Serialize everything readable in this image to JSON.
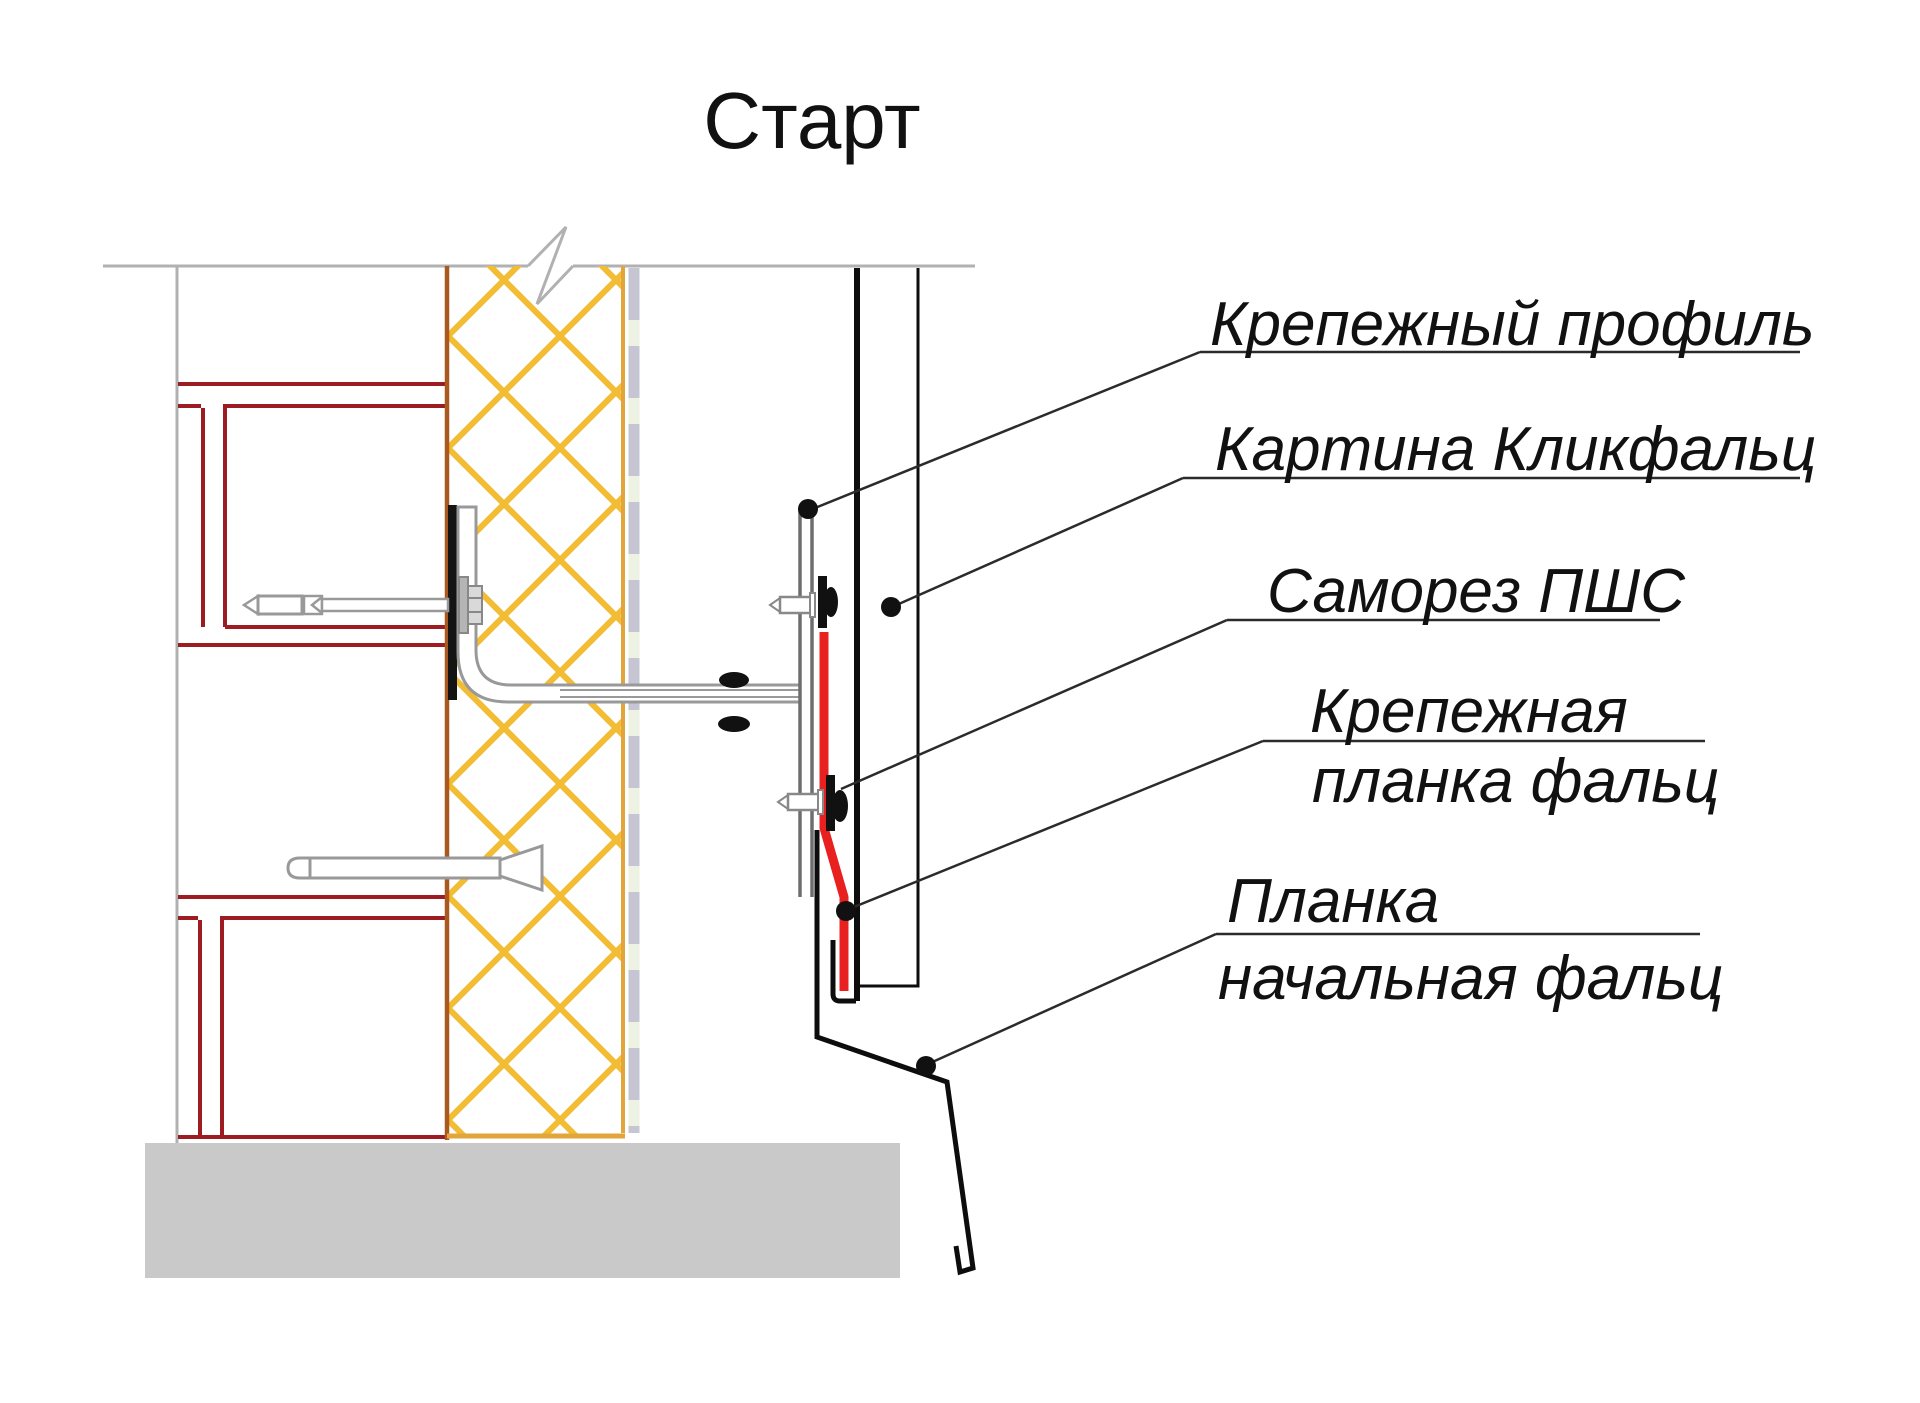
{
  "title": "Старт",
  "labels": {
    "fastening_profile": "Крепежный профиль",
    "clickfalz_panel": "Картина Кликфальц",
    "screw_pshs": "Саморез ПШС",
    "fastening_strip_line1": "Крепежная",
    "fastening_strip_line2": "планка фальц",
    "starting_strip_line1": "Планка",
    "starting_strip_line2": "начальная фальц"
  },
  "colors": {
    "frame_red": "#9c1c22",
    "accent_red": "#e92020",
    "insulation_yellow": "#f2bd35",
    "wall_face_brown": "#a9591f",
    "insulation_edge_orange": "#e2a53b",
    "gray_line": "#b1b1b1",
    "base_gray": "#c9c9c9",
    "membrane_lavender": "#c5c5d3",
    "membrane_gap_green": "#eef2e2",
    "ink": "#111111",
    "leader_ink": "#2b2b2b",
    "bracket_gray": "#999999"
  }
}
